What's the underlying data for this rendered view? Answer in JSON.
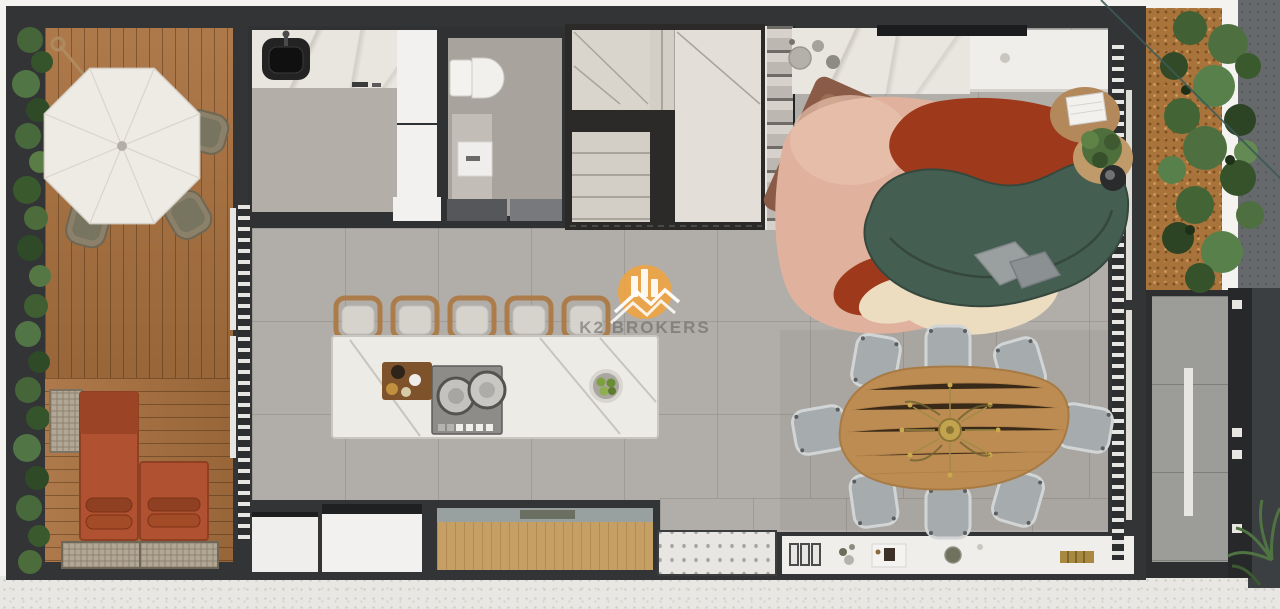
{
  "watermark": {
    "brand": "K2 BROKERS",
    "icon": "k2-buildings-icon",
    "icon_color": "#F2A33C",
    "text_color": "#5F5F5F"
  },
  "palette": {
    "wall_charcoal": "#323436",
    "floor_tile_gray": "#B1AEA9",
    "deck_wood": "#A9713F",
    "hedge_green": "#4C6C3B",
    "umbrella_white": "#EEEBE5",
    "lounger_terracotta": "#B05231",
    "sofa_green": "#445E52",
    "rug_blush": "#E0B29E",
    "rug_rust": "#9E3A1B",
    "rug_cream": "#ECDCC0",
    "armchair_brown": "#9D6E55",
    "dining_table_wood": "#BD8C52",
    "dining_chair_gray": "#A6ABAD",
    "island_marble": "#EDEBE6",
    "stool_wood": "#AD7C4B",
    "cabinet_wood": "#C69F64",
    "chandelier_gold": "#C3A44E",
    "exterior_concrete": "#E9E7E3"
  }
}
